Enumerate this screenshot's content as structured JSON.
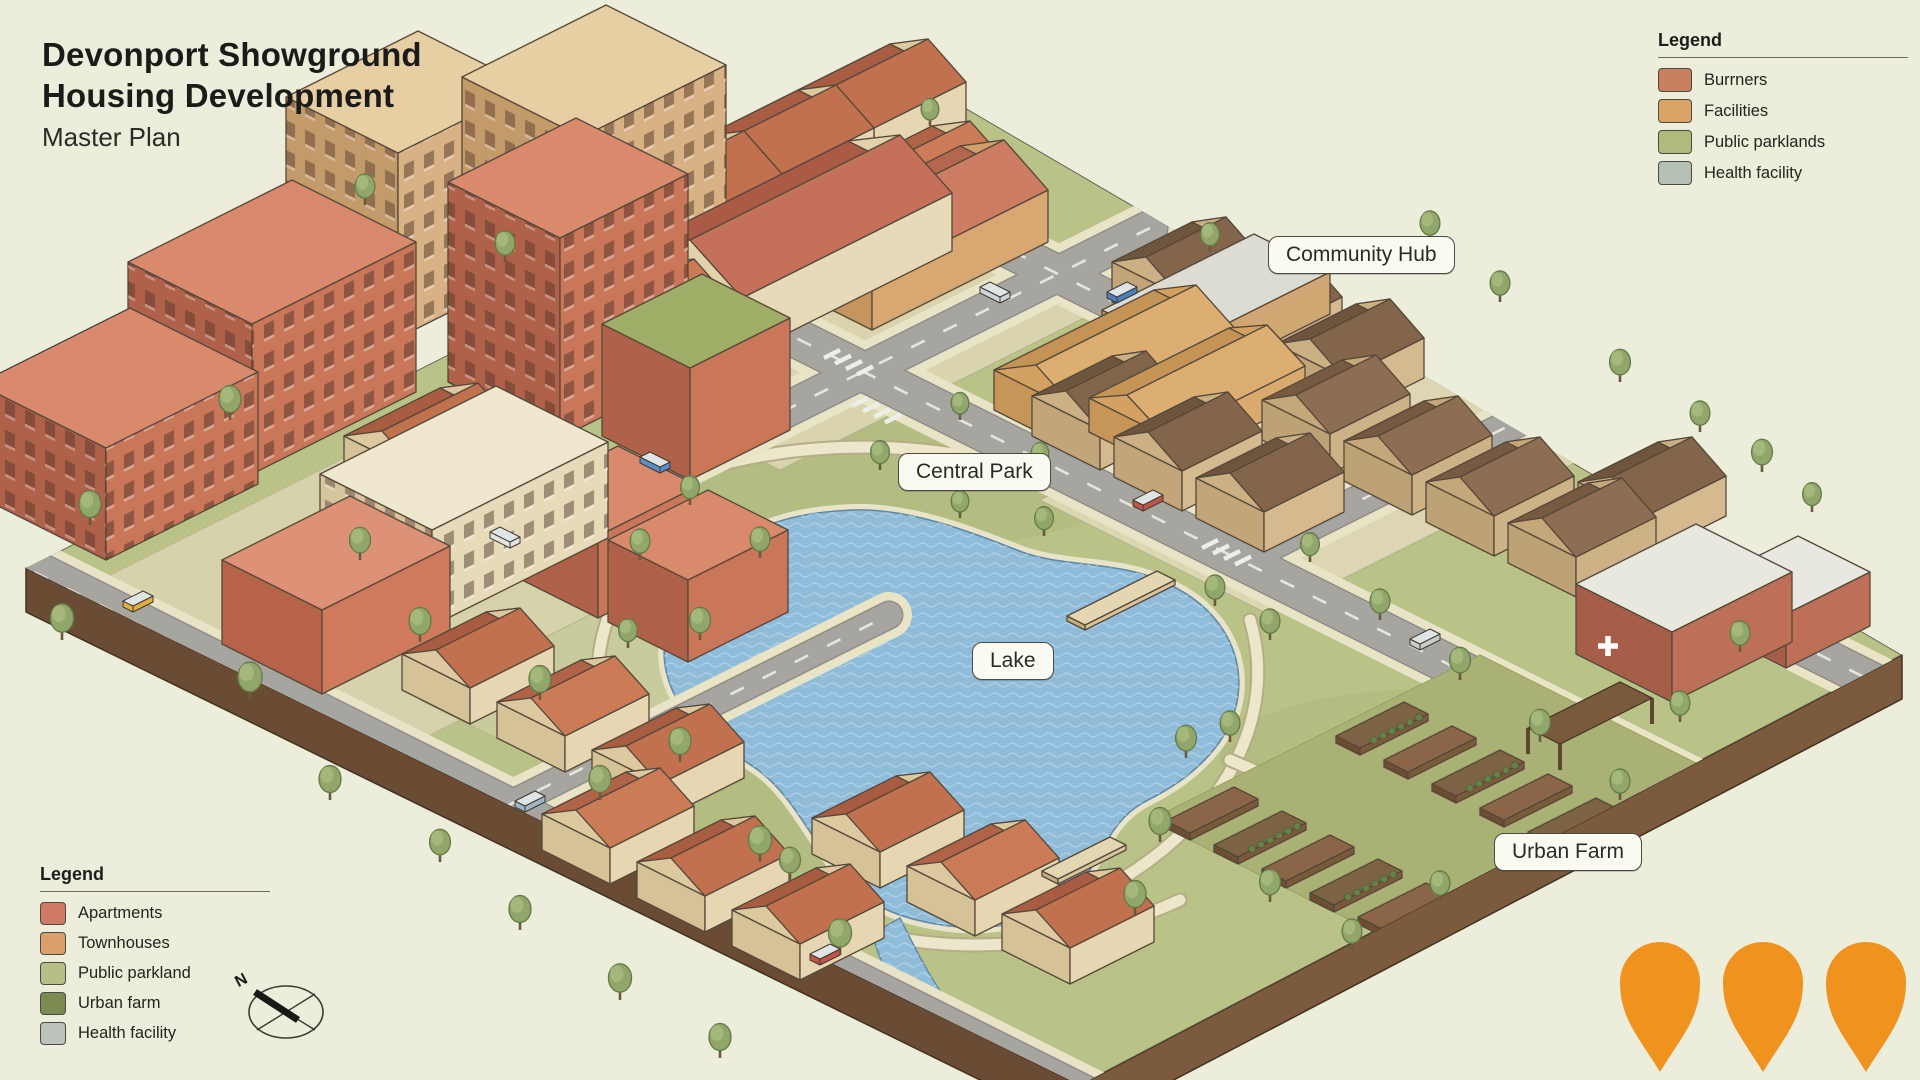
{
  "title": {
    "line1": "Devonport Showground",
    "line2": "Housing Development",
    "subtitle": "Master Plan"
  },
  "map_labels": {
    "community_hub": "Community Hub",
    "central_park": "Central Park",
    "lake": "Lake",
    "urban_farm": "Urban Farm"
  },
  "legend_top_right": {
    "title": "Legend",
    "items": [
      {
        "label": "Burrners",
        "color": "#c9805f"
      },
      {
        "label": "Facilities",
        "color": "#d9a466"
      },
      {
        "label": "Public parklands",
        "color": "#b0ba7a"
      },
      {
        "label": "Health facility",
        "color": "#b4c0b4"
      }
    ]
  },
  "legend_bottom_left": {
    "title": "Legend",
    "items": [
      {
        "label": "Apartments",
        "color": "#ce7a64"
      },
      {
        "label": "Townhouses",
        "color": "#d9a06b"
      },
      {
        "label": "Public parkland",
        "color": "#b7bf86"
      },
      {
        "label": "Urban farm",
        "color": "#7c8b51"
      },
      {
        "label": "Health facility",
        "color": "#bcc3bc"
      }
    ]
  },
  "compass": {
    "north_label": "N"
  },
  "map_pins": {
    "count": 3,
    "color": "#f0921e"
  },
  "palette": {
    "background": "#ecedda",
    "ground": "#b9c287",
    "road": "#a6a5a0",
    "sidewalk": "#e9e4c6",
    "water": "#8fbcd9",
    "site_edge": "#6f5038"
  }
}
